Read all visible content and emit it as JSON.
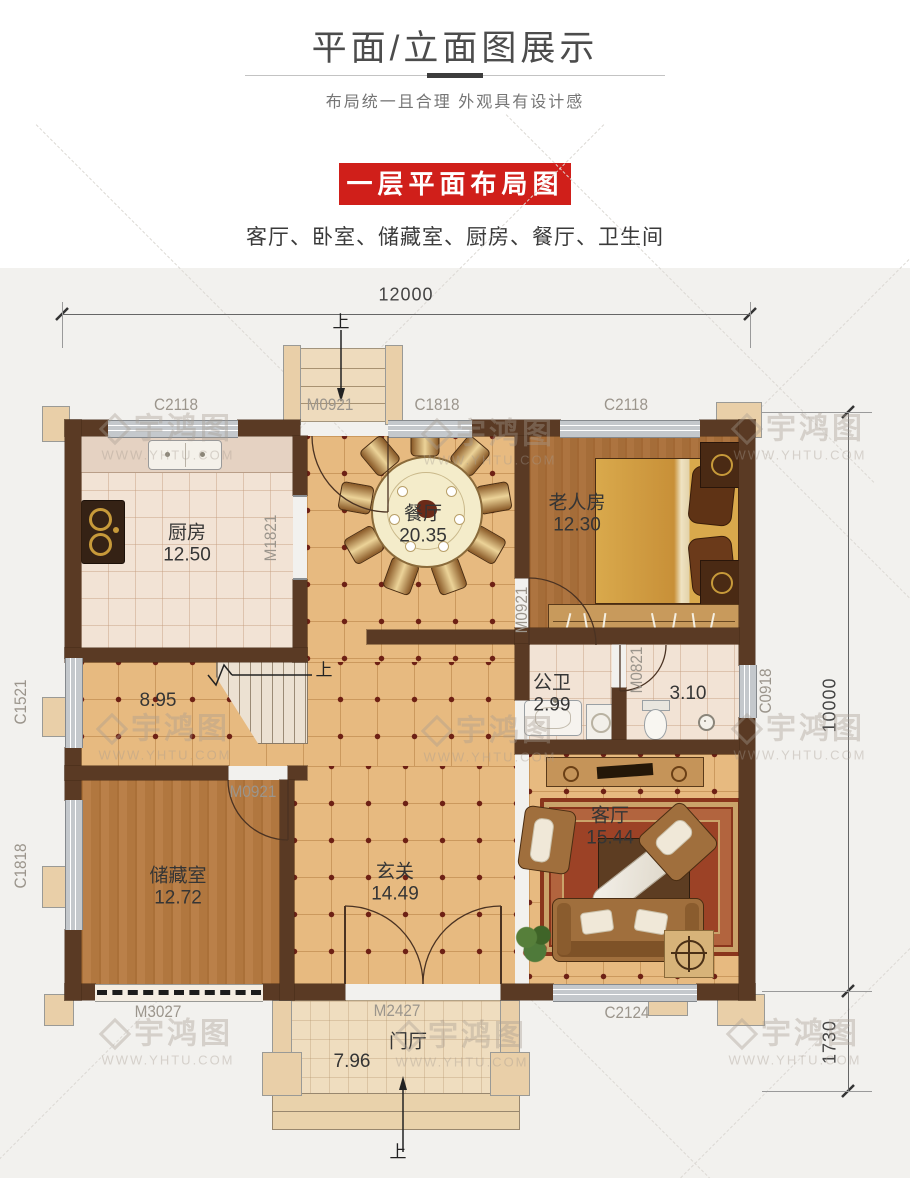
{
  "header": {
    "title": "平面/立面图展示",
    "subtitle": "布局统一且合理  外观具有设计感"
  },
  "badge": {
    "label": "一层平面布局图",
    "bg": "#d01f1a"
  },
  "room_list": "客厅、卧室、储藏室、厨房、餐厅、卫生间",
  "watermark": {
    "brand": "宇鸿图",
    "site": "WWW.YHTU.COM"
  },
  "dimensions": {
    "width_total": "12000",
    "height_main": "10000",
    "porch_depth": "1730"
  },
  "up_label": "上",
  "rooms": {
    "kitchen": {
      "name": "厨房",
      "area": "12.50"
    },
    "dining": {
      "name": "餐厅",
      "area": "20.35"
    },
    "elder_room": {
      "name": "老人房",
      "area": "12.30"
    },
    "stair_hall": {
      "area": "8.95"
    },
    "bath": {
      "name": "公卫",
      "area": "2.99"
    },
    "toilet": {
      "area": "3.10"
    },
    "storage": {
      "name": "储藏室",
      "area": "12.72"
    },
    "foyer": {
      "name": "玄关",
      "area": "14.49"
    },
    "living": {
      "name": "客厅",
      "area": "15.44"
    },
    "porch": {
      "name": "门厅",
      "area": "7.96"
    }
  },
  "openings": {
    "c2118_kitchen": "C2118",
    "m0921_entry_top": "M0921",
    "c1818_dining": "C1818",
    "c2118_elder": "C2118",
    "m1821_kitchen": "M1821",
    "m0921_elder": "M0921",
    "m0821_bath": "M0821",
    "c0918_toilet": "C0918",
    "c1521_hall": "C1521",
    "c1818_storage": "C1818",
    "m0921_storage": "M0921",
    "m3027_storage": "M3027",
    "m2427_entry": "M2427",
    "c2124_living": "C2124"
  }
}
